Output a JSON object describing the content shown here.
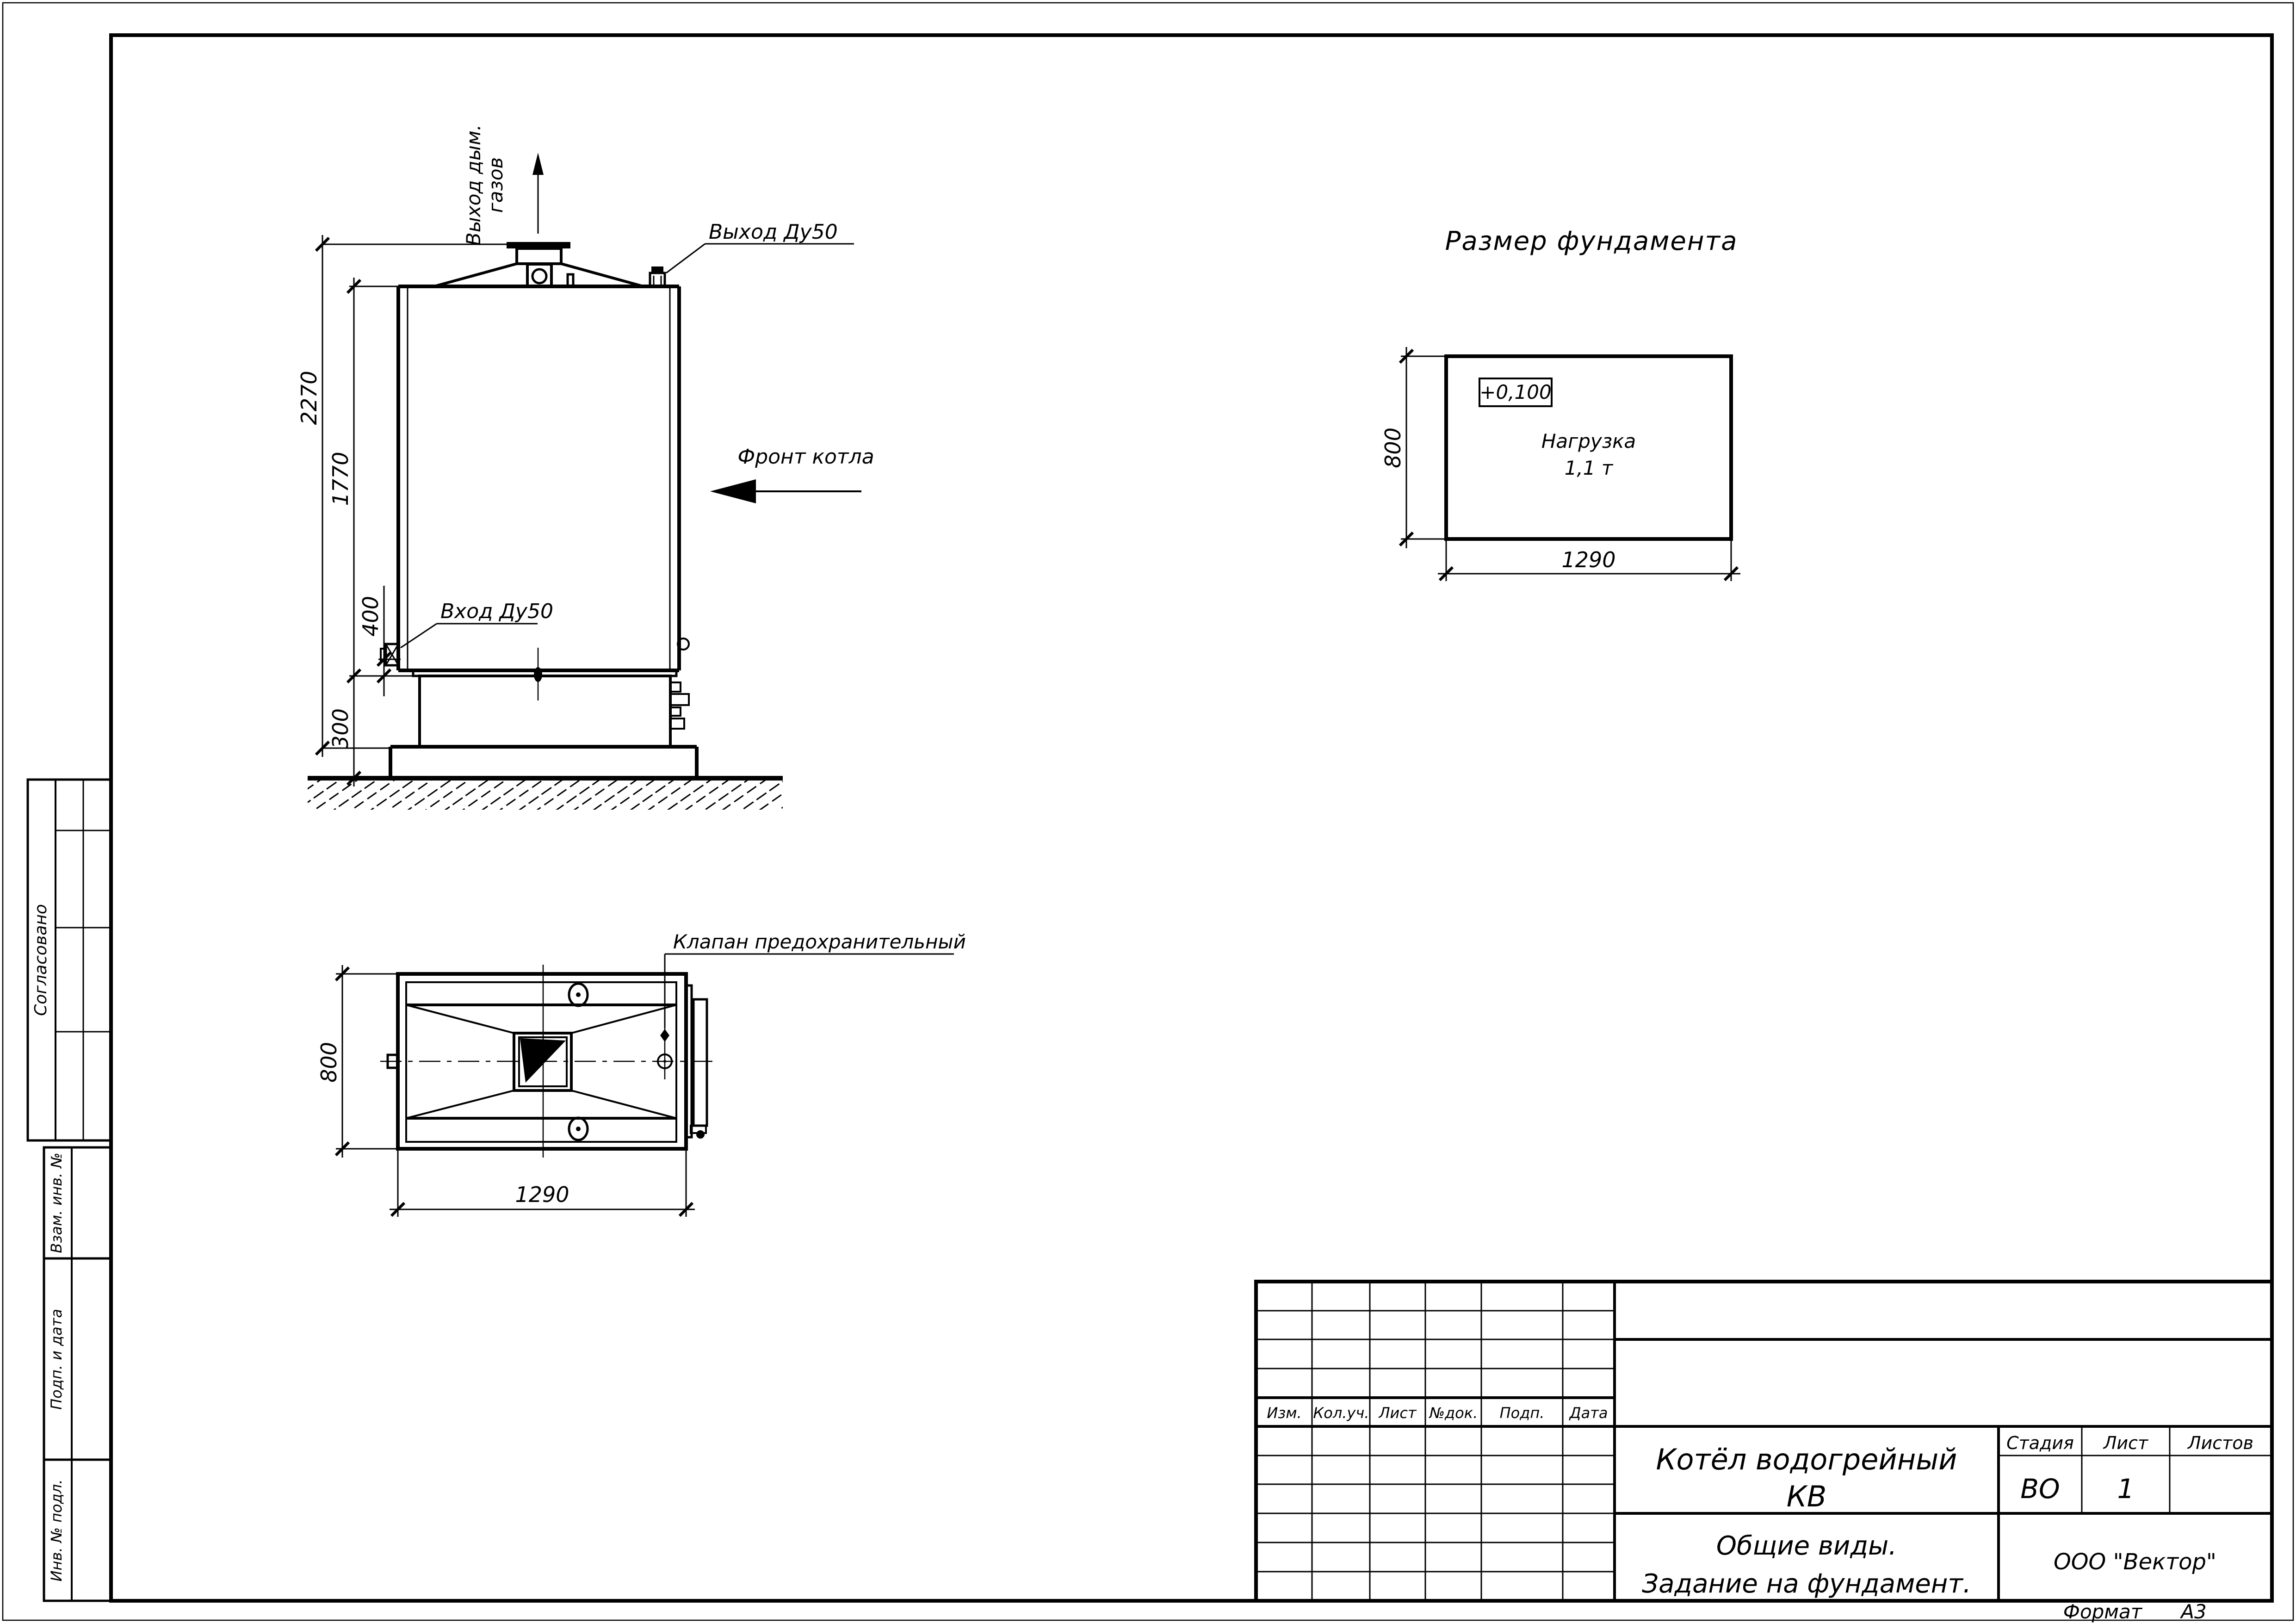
{
  "sheet": {
    "format_label": "Формат",
    "format_value": "А3"
  },
  "front_view": {
    "flue_label_line1": "Выход дым.",
    "flue_label_line2": "газов",
    "outlet_label": "Выход Ду50",
    "front_label": "Фронт котла",
    "inlet_label": "Вход Ду50",
    "dim_total_height": "2270",
    "dim_body_height": "1770",
    "dim_inlet_height": "400",
    "dim_base_height": "300"
  },
  "plan_view": {
    "valve_label": "Клапан предохранительный",
    "dim_width": "800",
    "dim_length": "1290"
  },
  "foundation_plan": {
    "title": "Размер фундамента",
    "elevation": "+0,100",
    "load_label": "Нагрузка",
    "load_value": "1,1 т",
    "dim_width": "800",
    "dim_length": "1290"
  },
  "title_block": {
    "revision_headers": [
      "Изм.",
      "Кол.уч.",
      "Лист",
      "№док.",
      "Подп.",
      "Дата"
    ],
    "object_name_line1": "Котёл водогрейный",
    "object_name_line2": "КВ",
    "stage_label": "Стадия",
    "sheet_label": "Лист",
    "sheets_label": "Листов",
    "stage_value": "ВО",
    "sheet_value": "1",
    "sheets_value": "",
    "doc_title_line1": "Общие виды.",
    "doc_title_line2": "Задание на фундамент.",
    "company": "ООО \"Вектор\""
  },
  "side_stamp": {
    "approved": "Согласовано",
    "replace_inv": "Взам. инв. №",
    "sign_date": "Подп. и дата",
    "inv_orig": "Инв. № подл."
  }
}
